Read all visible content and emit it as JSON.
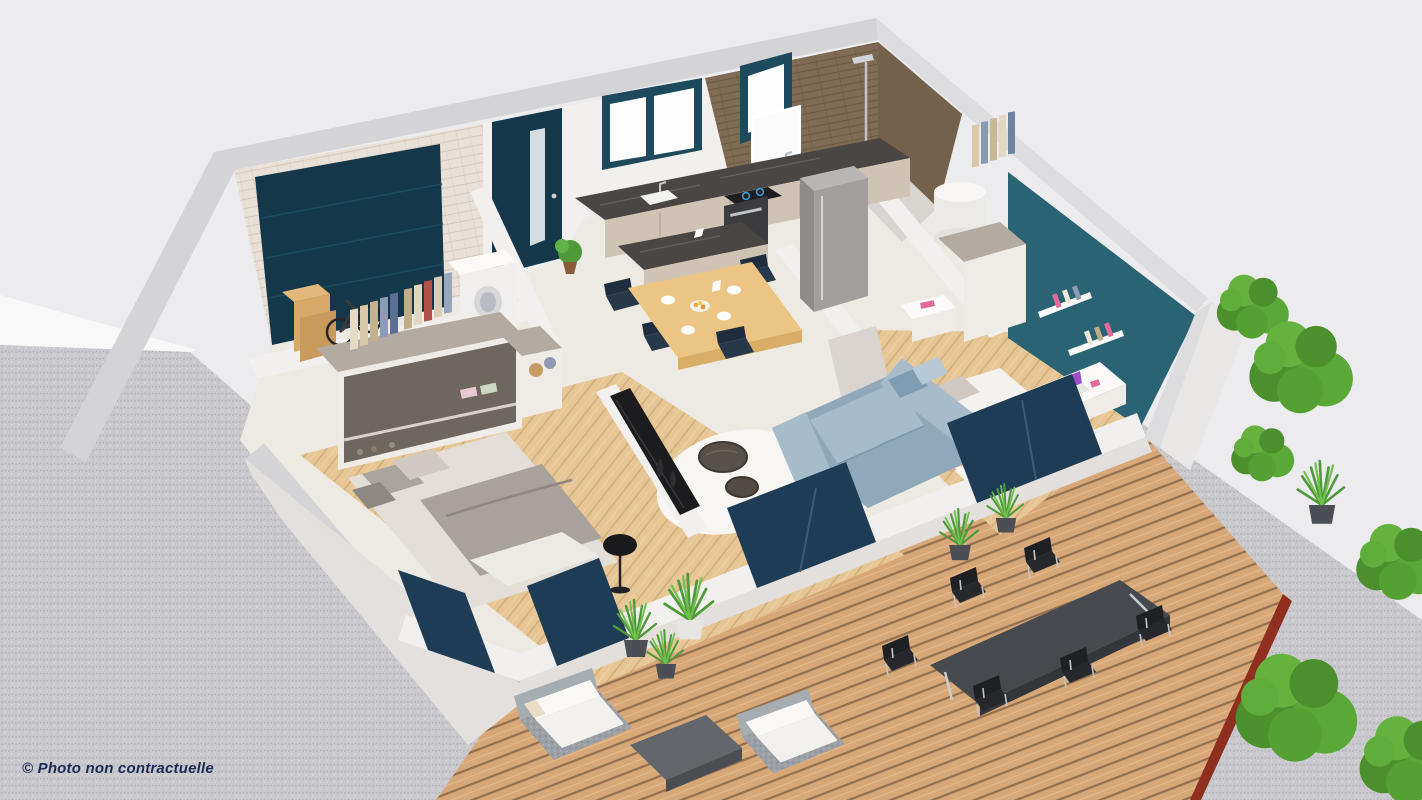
{
  "caption": {
    "text": "© Photo non contractuelle"
  },
  "colors": {
    "background": "#ecebee",
    "gravel": "#c9c8cc",
    "deck_wood": "#d7a777",
    "wall_white": "#f2f0ee",
    "wall_cap": "#d4d3d6",
    "brick": "#e9e1d7",
    "accent_teal": "#2a6474",
    "door_teal": "#14384a",
    "window_frame": "#1d4a5c",
    "glass_navy": "#1e3c55",
    "floor_tile": "#edeae3",
    "floor_wood": "#e7c696",
    "counter_marble": "#4a4644",
    "cabinet": "#cfc4b4",
    "sofa_blue": "#8fa9bb",
    "rug": "#f7f6f2",
    "bush_green": "#57a035",
    "grass_green": "#4e9a3a",
    "salmon": "#eba87f",
    "charcoal": "#2b2d31",
    "red_edge": "#8e2f1f",
    "caption_navy": "#1b2a52"
  },
  "scene": {
    "type": "3d-floor-plan-render",
    "rooms": [
      "garage",
      "entrance-hall",
      "kitchen",
      "bathroom",
      "bedroom-left",
      "bedroom-right",
      "living-room",
      "terrace"
    ],
    "garage_items": [
      "garage-door",
      "cardboard-boxes",
      "bicycle",
      "washing-machine"
    ],
    "kitchen_items": [
      "counter",
      "cooktop",
      "oven",
      "fridge",
      "island",
      "dining-table",
      "chairs",
      "plates",
      "fruit-bowl",
      "plant"
    ],
    "bathroom_items": [
      "window",
      "mirror",
      "sink",
      "shower",
      "water-heater"
    ],
    "bedroom_left_items": [
      "open-wardrobe",
      "double-bed",
      "floor-lamp"
    ],
    "bedroom_right_items": [
      "wardrobe",
      "teal-accent-wall",
      "wall-shelves",
      "desk",
      "laptop",
      "chair",
      "bed"
    ],
    "living_room_items": [
      "sofa",
      "round-rug",
      "coffee-tables",
      "tv-partition",
      "floor-lamp",
      "vases"
    ],
    "terrace_items": [
      "wood-deck",
      "wicker-armchairs",
      "low-table",
      "dining-table",
      "dining-chairs",
      "grass-pots"
    ],
    "outdoor": [
      "gravel-driveway",
      "green-bushes",
      "red-deck-edge"
    ]
  }
}
